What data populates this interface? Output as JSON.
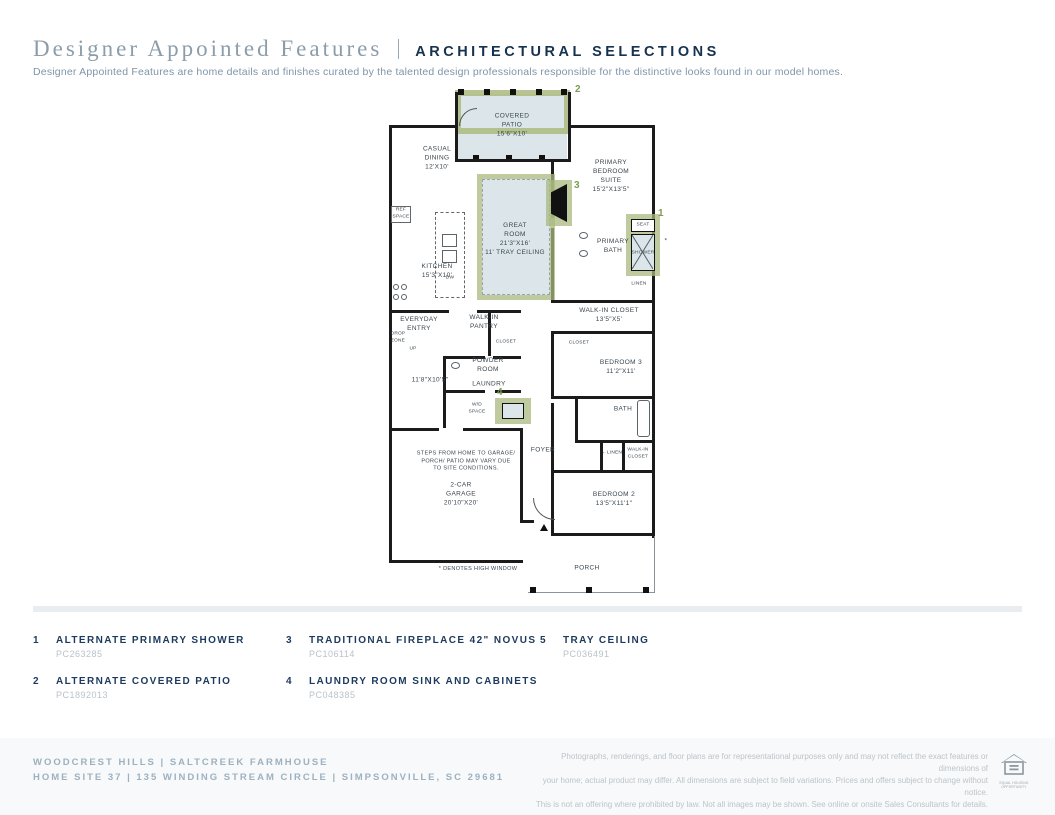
{
  "header": {
    "title": "Designer Appointed Features",
    "tag": "ARCHITECTURAL SELECTIONS",
    "description": "Designer Appointed Features are home details and finishes curated by the talented design professionals responsible for the distinctive looks found in our model homes."
  },
  "plan": {
    "labels": {
      "covered_patio": "COVERED\nPATIO\n15'6\"X10'",
      "casual_dining": "CASUAL\nDINING\n12'X10'",
      "primary_suite": "PRIMARY\nBEDROOM\nSUITE\n15'2\"X13'5\"",
      "great_room": "GREAT\nROOM\n21'3\"X16'\n11' TRAY CEILING",
      "ref_space": "REF\nSPACE",
      "dw": "DW",
      "kitchen": "KITCHEN\n15'3\"X10'",
      "primary_bath": "PRIMARY\nBATH",
      "seat": "SEAT",
      "shower": "SHOWER",
      "linen_upper": "LINEN",
      "wic_primary": "WALK-IN CLOSET\n13'5\"X5'",
      "everyday_entry": "EVERYDAY\nENTRY",
      "drop_zone": "DROP\nZONE",
      "up": "UP",
      "walk_in_pantry": "WALK-IN\nPANTRY",
      "closet_hall": "CLOSET",
      "powder_room": "POWDER\nROOM",
      "flex_dims": "11'8\"X10'5\"",
      "laundry": "LAUNDRY",
      "wd_space": "W/D\nSPACE",
      "closet_bed3": "CLOSET",
      "bedroom3": "BEDROOM 3\n11'2\"X11'",
      "bath2": "BATH",
      "steps_note": "STEPS FROM HOME TO GARAGE/\nPORCH/ PATIO MAY VARY DUE\nTO SITE CONDITIONS.",
      "foyer": "FOYER",
      "linen_lower": "←LINEN",
      "wic_bed2": "WALK-IN\nCLOSET",
      "garage": "2-CAR\nGARAGE\n20'10\"X20'",
      "bedroom2": "BEDROOM 2\n13'5\"X11'1\"",
      "high_window_note": "* DENOTES HIGH WINDOW",
      "porch": "PORCH",
      "high_window_mark": "*"
    },
    "markers": {
      "shower_num": "1",
      "patio_num": "2",
      "fireplace_num": "3",
      "laundry_num": "4"
    },
    "colors": {
      "highlight_green": "#aaba7e",
      "room_fill_blue": "#dce6ea",
      "marker_green": "#7f9d50",
      "wall_black": "#1b1b1b"
    }
  },
  "legend": {
    "items": [
      {
        "num": "1",
        "title": "ALTERNATE PRIMARY SHOWER",
        "code": "PC263285"
      },
      {
        "num": "2",
        "title": "ALTERNATE COVERED PATIO",
        "code": "PC1892013"
      },
      {
        "num": "3",
        "title": "TRADITIONAL FIREPLACE 42\" NOVUS",
        "code": "PC106114"
      },
      {
        "num": "4",
        "title": "LAUNDRY ROOM SINK AND CABINETS",
        "code": "PC048385"
      },
      {
        "num": "5",
        "title": "TRAY CEILING",
        "code": "PC036491"
      }
    ]
  },
  "footer": {
    "community_line": "WOODCREST HILLS   |   SALTCREEK FARMHOUSE",
    "address_line": "HOME SITE 37   |   135 WINDING STREAM CIRCLE   |   SIMPSONVILLE, SC 29681",
    "disclaimer": "Photographs, renderings, and floor plans are for representational purposes only and may not reflect the exact features or dimensions of\nyour home; actual product may differ. All dimensions are subject to field variations. Prices and offers subject to change without notice.\nThis is not an offering where prohibited by law. Not all images may be shown. See online or onsite Sales Consultants for details.",
    "equal_housing": "EQUAL HOUSING\nOPPORTUNITY"
  }
}
